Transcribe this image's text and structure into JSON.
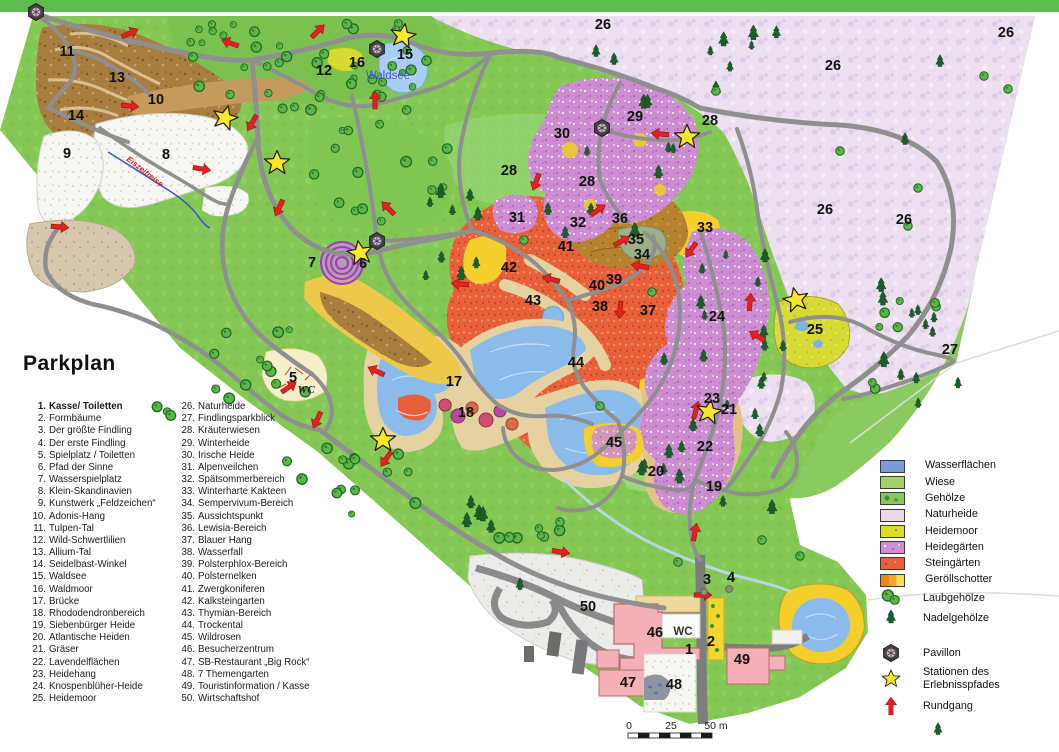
{
  "title": "Parkplan",
  "numbered_items": [
    {
      "n": 1,
      "label": "Kasse/ Toiletten",
      "bold": true
    },
    {
      "n": 2,
      "label": "Formbäume",
      "bold": false
    },
    {
      "n": 3,
      "label": "Der größte Findling",
      "bold": false
    },
    {
      "n": 4,
      "label": "Der erste Findling",
      "bold": false
    },
    {
      "n": 5,
      "label": "Spielplatz / Toiletten",
      "bold": false
    },
    {
      "n": 6,
      "label": "Pfad der Sinne",
      "bold": false
    },
    {
      "n": 7,
      "label": "Wasserspielplatz",
      "bold": false
    },
    {
      "n": 8,
      "label": "Klein-Skandinavien",
      "bold": false
    },
    {
      "n": 9,
      "label": "Kunstwerk „Feldzeichen“",
      "bold": false
    },
    {
      "n": 10,
      "label": "Adonis-Hang",
      "bold": false
    },
    {
      "n": 11,
      "label": "Tulpen-Tal",
      "bold": false
    },
    {
      "n": 12,
      "label": "Wild-Schwertlilien",
      "bold": false
    },
    {
      "n": 13,
      "label": "Allium-Tal",
      "bold": false
    },
    {
      "n": 14,
      "label": "Seidelbast-Winkel",
      "bold": false
    },
    {
      "n": 15,
      "label": "Waldsee",
      "bold": false
    },
    {
      "n": 16,
      "label": "Waldmoor",
      "bold": false
    },
    {
      "n": 17,
      "label": "Brücke",
      "bold": false
    },
    {
      "n": 18,
      "label": "Rhododendronbereich",
      "bold": false
    },
    {
      "n": 19,
      "label": "Siebenbürger Heide",
      "bold": false
    },
    {
      "n": 20,
      "label": "Atlantische Heiden",
      "bold": false
    },
    {
      "n": 21,
      "label": "Gräser",
      "bold": false
    },
    {
      "n": 22,
      "label": "Lavendelflächen",
      "bold": false
    },
    {
      "n": 23,
      "label": "Heidehang",
      "bold": false
    },
    {
      "n": 24,
      "label": "Knospenblüher-Heide",
      "bold": false
    },
    {
      "n": 25,
      "label": "Heidemoor",
      "bold": false
    },
    {
      "n": 26,
      "label": "Naturheide",
      "bold": false
    },
    {
      "n": 27,
      "label": "Findlingsparkblick",
      "bold": false
    },
    {
      "n": 28,
      "label": "Kräuterwiesen",
      "bold": false
    },
    {
      "n": 29,
      "label": "Winterheide",
      "bold": false
    },
    {
      "n": 30,
      "label": "Irische Heide",
      "bold": false
    },
    {
      "n": 31,
      "label": "Alpenveilchen",
      "bold": false
    },
    {
      "n": 32,
      "label": "Spätsommerbereich",
      "bold": false
    },
    {
      "n": 33,
      "label": "Winterharte Kakteen",
      "bold": false
    },
    {
      "n": 34,
      "label": "Sempervivum-Bereich",
      "bold": false
    },
    {
      "n": 35,
      "label": "Aussichtspunkt",
      "bold": false
    },
    {
      "n": 36,
      "label": "Lewisia-Bereich",
      "bold": false
    },
    {
      "n": 37,
      "label": "Blauer Hang",
      "bold": false
    },
    {
      "n": 38,
      "label": "Wasserfall",
      "bold": false
    },
    {
      "n": 39,
      "label": "Polsterphlox-Bereich",
      "bold": false
    },
    {
      "n": 40,
      "label": "Polsternelken",
      "bold": false
    },
    {
      "n": 41,
      "label": "Zwergkoniferen",
      "bold": false
    },
    {
      "n": 42,
      "label": "Kalksteingarten",
      "bold": false
    },
    {
      "n": 43,
      "label": "Thymian-Bereich",
      "bold": false
    },
    {
      "n": 44,
      "label": "Trockental",
      "bold": false
    },
    {
      "n": 45,
      "label": "Wildrosen",
      "bold": false
    },
    {
      "n": 46,
      "label": "Besucherzentrum",
      "bold": false
    },
    {
      "n": 47,
      "label": "SB-Restaurant „Big Rock“",
      "bold": false
    },
    {
      "n": 48,
      "label": "7 Themengarten",
      "bold": false
    },
    {
      "n": 49,
      "label": "Touristinformation / Kasse",
      "bold": false
    },
    {
      "n": 50,
      "label": "Wirtschaftshof",
      "bold": false
    }
  ],
  "color_legend": [
    {
      "kind": "water",
      "label": "Wasserflächen"
    },
    {
      "kind": "wiese",
      "label": "Wiese"
    },
    {
      "kind": "gehoelze",
      "label": "Gehölze"
    },
    {
      "kind": "naturheide",
      "label": "Naturheide"
    },
    {
      "kind": "heidemoor",
      "label": "Heidemoor"
    },
    {
      "kind": "heidegaerten",
      "label": "Heidegärten"
    },
    {
      "kind": "steingaerten",
      "label": "Steingärten"
    },
    {
      "kind": "geroellschotter",
      "label": "Geröllschotter"
    },
    {
      "kind": "laub",
      "label": "Laubgehölze"
    },
    {
      "kind": "nadel",
      "label": "Nadelgehölze"
    },
    {
      "kind": "pavillon",
      "label": "Pavillon"
    },
    {
      "kind": "station",
      "label": "Stationen des Erlebnisspfades"
    },
    {
      "kind": "rundgang",
      "label": "Rundgang"
    }
  ],
  "colors": {
    "water": "#8abbea",
    "wiese": "#84c755",
    "naturheide": "#ebdff0",
    "heidemoor": "#d7d935",
    "heidegaerten": "#cd8dd1",
    "steingaerten": "#e8603a",
    "geroellschotter": "#f0a828",
    "path_gray": "#8f8f8f",
    "arrow_red": "#e02320",
    "star_yellow": "#f8e72b"
  },
  "map": {
    "waldsee_label": "Waldsee",
    "wc_playground": "WC",
    "wc_center": "WC",
    "stream_label": "Eiszeitreise",
    "scale": {
      "start": "0",
      "mid": "25",
      "end": "50 m"
    },
    "number_labels": [
      [
        "1",
        689,
        649
      ],
      [
        "2",
        711,
        641
      ],
      [
        "3",
        707,
        579
      ],
      [
        "4",
        731,
        577
      ],
      [
        "5",
        293,
        377
      ],
      [
        "6",
        363,
        263
      ],
      [
        "7",
        312,
        262
      ],
      [
        "8",
        166,
        154
      ],
      [
        "9",
        67,
        153
      ],
      [
        "10",
        156,
        99
      ],
      [
        "11",
        67,
        51
      ],
      [
        "12",
        324,
        70
      ],
      [
        "13",
        117,
        77
      ],
      [
        "14",
        76,
        115
      ],
      [
        "15",
        405,
        54
      ],
      [
        "16",
        357,
        62
      ],
      [
        "17",
        454,
        381
      ],
      [
        "18",
        466,
        412
      ],
      [
        "19",
        714,
        486
      ],
      [
        "20",
        656,
        471
      ],
      [
        "21",
        729,
        409
      ],
      [
        "22",
        705,
        446
      ],
      [
        "23",
        712,
        398
      ],
      [
        "24",
        717,
        316
      ],
      [
        "25",
        815,
        329
      ],
      [
        "26",
        603,
        24
      ],
      [
        "26",
        833,
        65
      ],
      [
        "26",
        1006,
        32
      ],
      [
        "26",
        825,
        209
      ],
      [
        "26",
        904,
        219
      ],
      [
        "27",
        950,
        349
      ],
      [
        "28",
        509,
        170
      ],
      [
        "28",
        587,
        181
      ],
      [
        "28",
        710,
        120
      ],
      [
        "29",
        635,
        116
      ],
      [
        "30",
        562,
        133
      ],
      [
        "31",
        517,
        217
      ],
      [
        "32",
        578,
        222
      ],
      [
        "33",
        705,
        227
      ],
      [
        "34",
        642,
        254
      ],
      [
        "35",
        636,
        239
      ],
      [
        "36",
        620,
        218
      ],
      [
        "37",
        648,
        310
      ],
      [
        "38",
        600,
        306
      ],
      [
        "39",
        614,
        279
      ],
      [
        "40",
        597,
        285
      ],
      [
        "41",
        566,
        246
      ],
      [
        "42",
        509,
        267
      ],
      [
        "43",
        533,
        300
      ],
      [
        "44",
        576,
        362
      ],
      [
        "45",
        614,
        442
      ],
      [
        "46",
        655,
        632
      ],
      [
        "47",
        628,
        682
      ],
      [
        "48",
        674,
        684
      ],
      [
        "49",
        742,
        659
      ],
      [
        "50",
        588,
        606
      ]
    ],
    "stars": [
      [
        225,
        118,
        15
      ],
      [
        277,
        163,
        0
      ],
      [
        403,
        36,
        10
      ],
      [
        687,
        137,
        0
      ],
      [
        360,
        253,
        -10
      ],
      [
        383,
        440,
        0
      ],
      [
        709,
        412,
        10
      ],
      [
        796,
        300,
        -12
      ]
    ],
    "pavilions": [
      [
        36,
        12
      ],
      [
        377,
        49
      ],
      [
        602,
        128
      ],
      [
        377,
        241
      ]
    ],
    "arrows": [
      [
        130,
        33,
        -25
      ],
      [
        230,
        43,
        200
      ],
      [
        318,
        31,
        -45
      ],
      [
        375,
        100,
        -90
      ],
      [
        130,
        106,
        5
      ],
      [
        252,
        123,
        120
      ],
      [
        202,
        169,
        10
      ],
      [
        279,
        208,
        115
      ],
      [
        388,
        208,
        225
      ],
      [
        60,
        227,
        5
      ],
      [
        660,
        134,
        185
      ],
      [
        536,
        182,
        110
      ],
      [
        598,
        210,
        -35
      ],
      [
        622,
        241,
        -30
      ],
      [
        640,
        266,
        190
      ],
      [
        691,
        250,
        125
      ],
      [
        460,
        284,
        185
      ],
      [
        551,
        279,
        195
      ],
      [
        620,
        310,
        95
      ],
      [
        696,
        410,
        -75
      ],
      [
        376,
        371,
        205
      ],
      [
        289,
        387,
        -35
      ],
      [
        317,
        420,
        115
      ],
      [
        386,
        459,
        125
      ],
      [
        561,
        552,
        10
      ],
      [
        695,
        532,
        -80
      ],
      [
        703,
        595,
        0
      ],
      [
        750,
        302,
        -85
      ],
      [
        757,
        336,
        210
      ]
    ],
    "boulders": [
      [
        704,
        592
      ],
      [
        729,
        589
      ]
    ],
    "tree_clusters": [
      [
        180,
        22,
        428,
        110,
        "laub",
        44
      ],
      [
        308,
        122,
        458,
        222,
        "laub",
        14
      ],
      [
        142,
        328,
        306,
        420,
        "laub",
        15
      ],
      [
        282,
        422,
        428,
        522,
        "laub",
        15
      ],
      [
        498,
        514,
        562,
        544,
        "laub",
        8
      ],
      [
        856,
        298,
        938,
        415,
        "laub",
        8
      ],
      [
        700,
        32,
        790,
        92,
        "nadel",
        7
      ],
      [
        424,
        188,
        478,
        300,
        "nadel",
        8
      ],
      [
        560,
        92,
        688,
        242,
        "nadel",
        9
      ],
      [
        678,
        252,
        772,
        515,
        "nadel",
        15
      ],
      [
        862,
        282,
        958,
        405,
        "nadel",
        12
      ],
      [
        640,
        432,
        700,
        484,
        "nadel",
        5
      ],
      [
        464,
        478,
        512,
        528,
        "nadel",
        5
      ],
      [
        756,
        340,
        800,
        430,
        "nadel",
        4
      ]
    ],
    "tree_singles": [
      [
        840,
        151,
        "laub"
      ],
      [
        918,
        188,
        "laub"
      ],
      [
        908,
        226,
        "laub"
      ],
      [
        716,
        91,
        "laub"
      ],
      [
        652,
        292,
        "laub"
      ],
      [
        600,
        406,
        "laub"
      ],
      [
        984,
        76,
        "laub"
      ],
      [
        1008,
        89,
        "laub"
      ],
      [
        432,
        190,
        "laub"
      ],
      [
        524,
        240,
        "laub"
      ],
      [
        560,
        522,
        "laub"
      ],
      [
        678,
        562,
        "laub"
      ],
      [
        762,
        540,
        "laub"
      ],
      [
        800,
        556,
        "laub"
      ],
      [
        596,
        52,
        "nadel"
      ],
      [
        614,
        60,
        "nadel"
      ],
      [
        940,
        62,
        "nadel"
      ],
      [
        905,
        140,
        "nadel"
      ],
      [
        548,
        210,
        "nadel"
      ],
      [
        470,
        196,
        "nadel"
      ],
      [
        664,
        360,
        "nadel"
      ],
      [
        520,
        585,
        "nadel"
      ],
      [
        938,
        730,
        "nadel"
      ]
    ]
  }
}
